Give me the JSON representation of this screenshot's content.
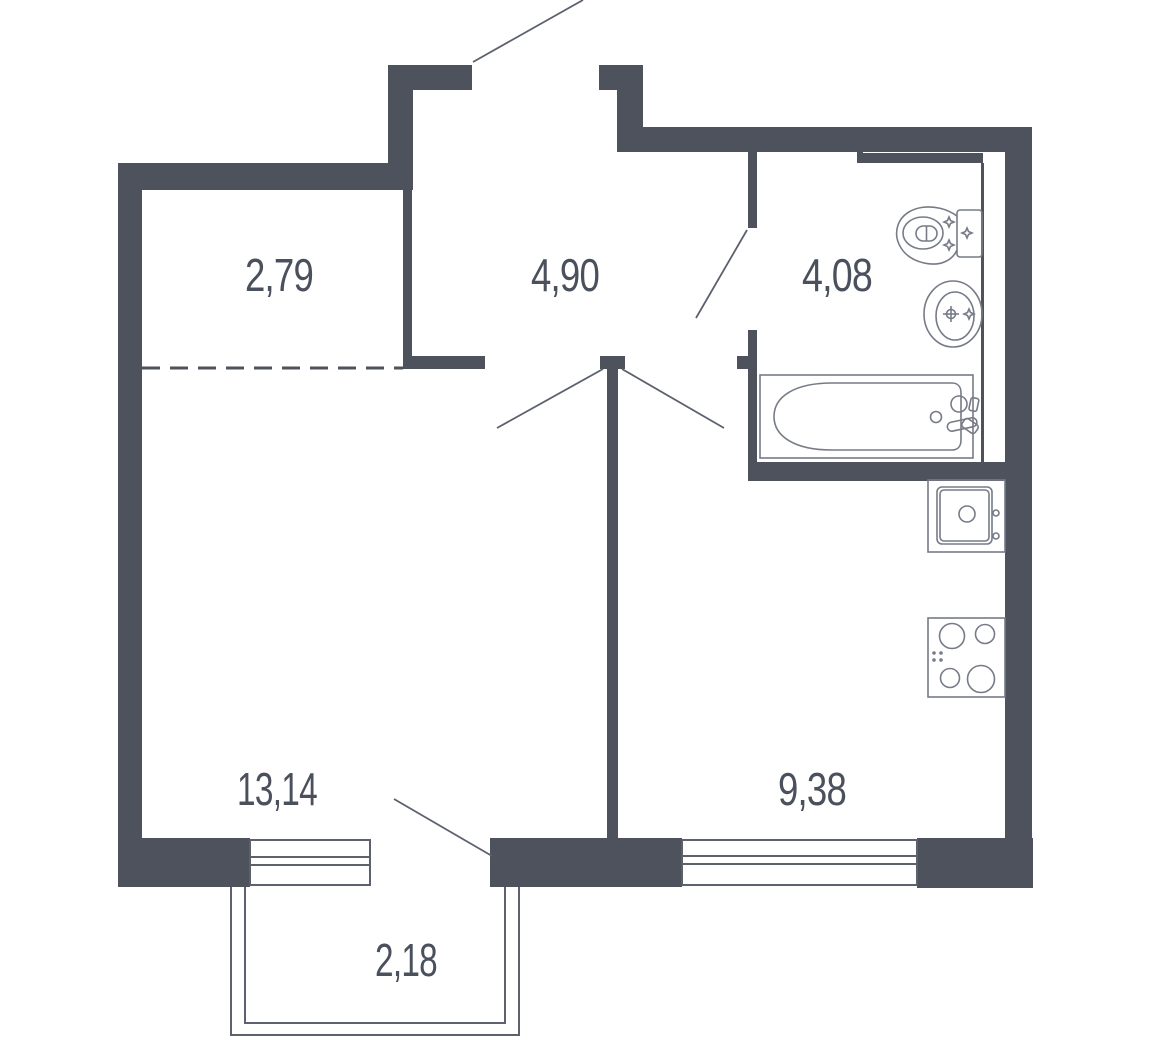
{
  "plan": {
    "title": "one-room apartment floor plan",
    "rooms": [
      {
        "name": "closet",
        "area_label": "2,79"
      },
      {
        "name": "hallway",
        "area_label": "4,90"
      },
      {
        "name": "bathroom",
        "area_label": "4,08"
      },
      {
        "name": "living-room",
        "area_label": "13,14"
      },
      {
        "name": "kitchen",
        "area_label": "9,38"
      },
      {
        "name": "balcony",
        "area_label": "2,18"
      }
    ],
    "fixtures": [
      "toilet",
      "washbasin",
      "bathtub",
      "kitchen-sink",
      "stove",
      "living-room-window",
      "kitchen-window",
      "balcony-railing"
    ],
    "colors": {
      "wall": "#4d525d",
      "fixture_line": "#767b87",
      "frame_line": "#5c616d",
      "text": "#4b505d",
      "background": "#ffffff"
    }
  }
}
